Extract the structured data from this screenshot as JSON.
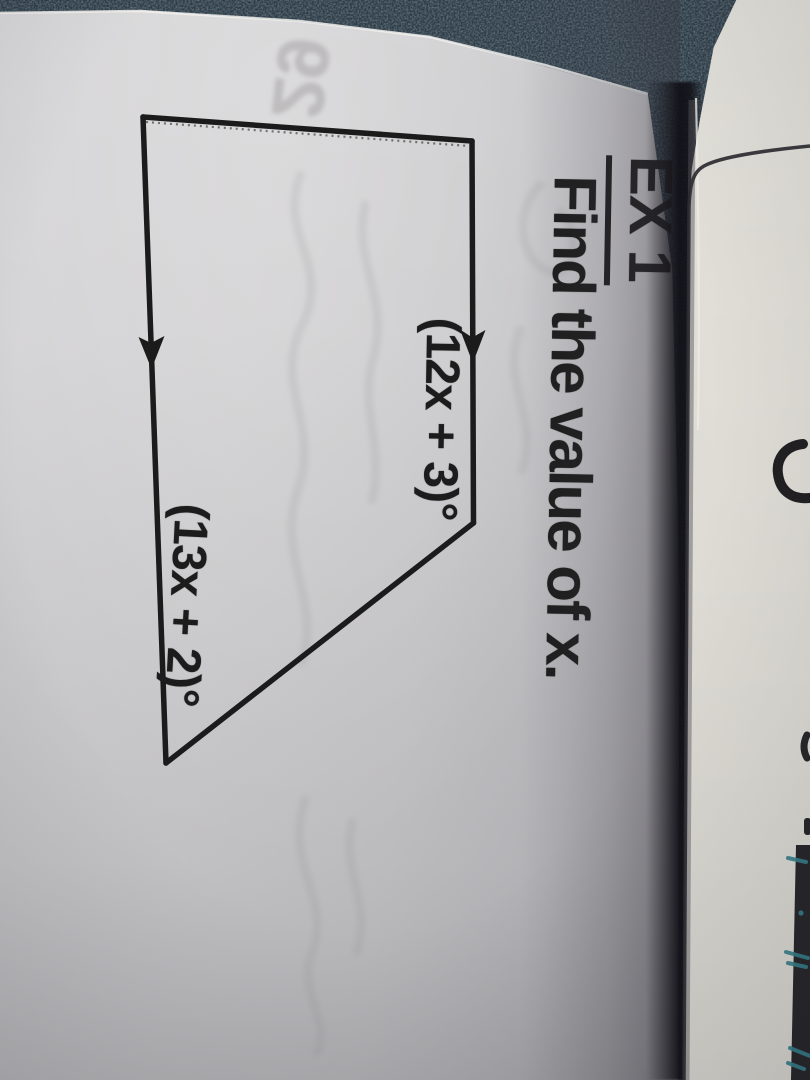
{
  "worksheet": {
    "heading": "EX 1",
    "prompt": "Find the value of x.",
    "figure": {
      "top_angle_label": "(12x + 3)°",
      "bottom_angle_label": "(13x + 2)°"
    },
    "bleedthrough_text": "29"
  },
  "colors": {
    "paper": "#cdccce",
    "facing_paper": "#dad8d1",
    "desk": "#2c3b46",
    "ink": "#1d1c1c",
    "pen_marks": "#36808c"
  }
}
